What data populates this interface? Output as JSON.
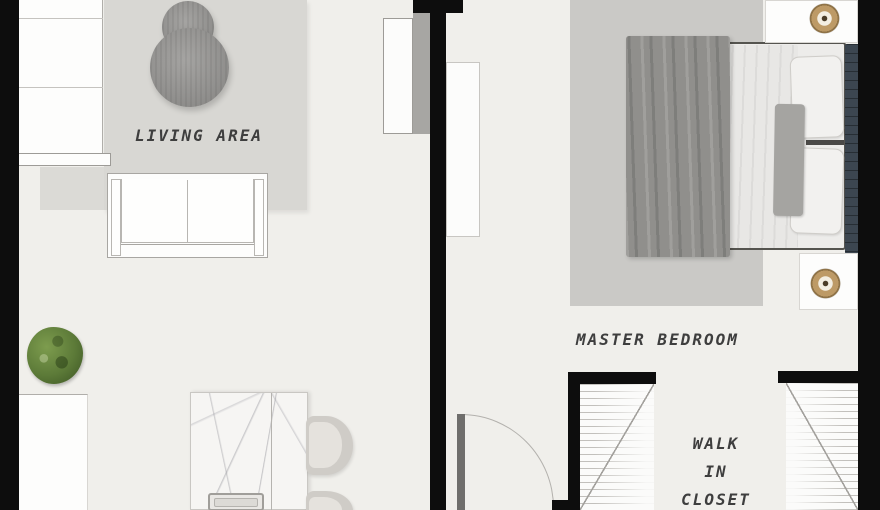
{
  "labels": {
    "living_area": "LIVING AREA",
    "master_bedroom": "MASTER BEDROOM",
    "walk_in_closet": {
      "line1": "WALK",
      "line2": "IN",
      "line3": "CLOSET"
    }
  },
  "colors": {
    "wall": "#0d0d0d",
    "floor": "#f0efeb",
    "rug_living": "#d8d7d3",
    "rug_bedroom": "#cac9c6",
    "label_text": "#3e3e3e",
    "plant_green": "#5c7a38",
    "lamp_tan": "#bd9a66",
    "headboard": "#3c4650",
    "blanket_gray": "#908f8c"
  }
}
